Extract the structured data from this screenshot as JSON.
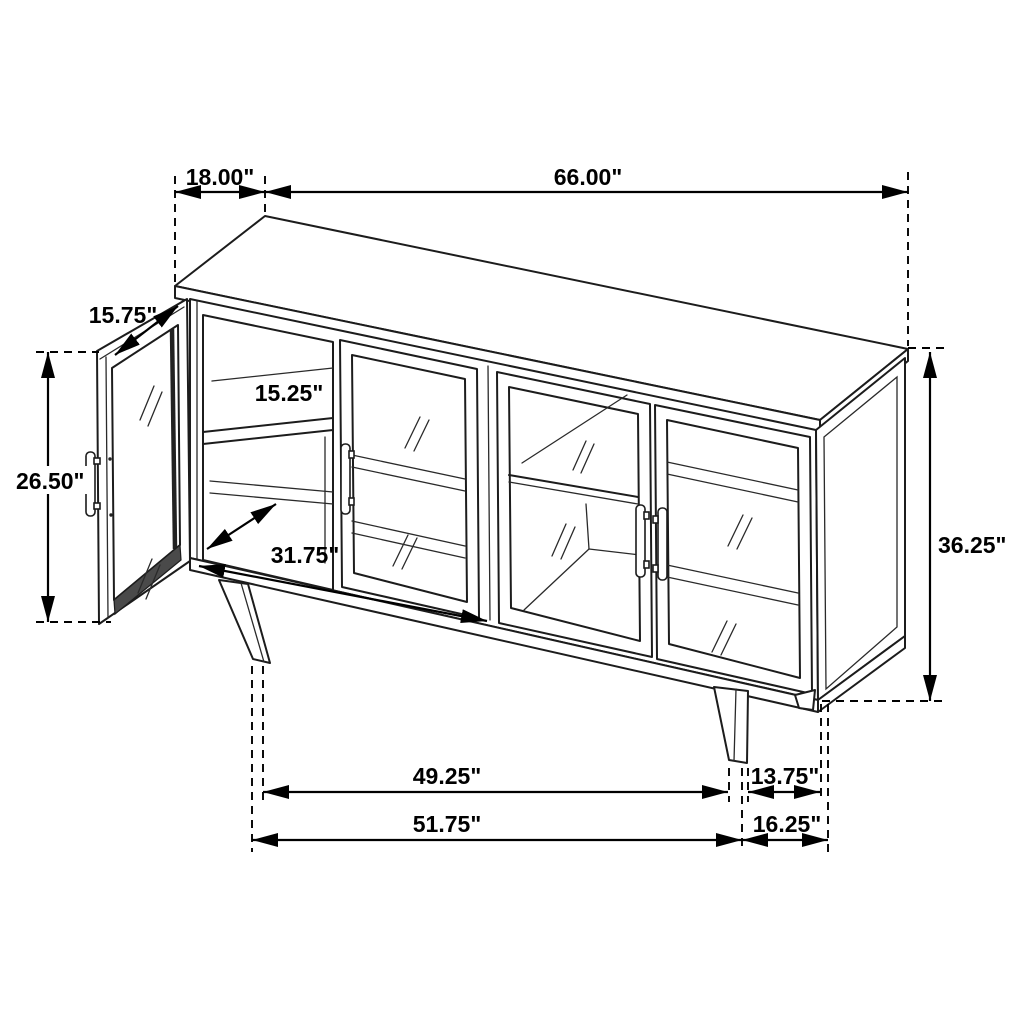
{
  "drawing": {
    "type": "furniture-dimension-diagram",
    "subject": "Sideboard accent cabinet with four glass doors, left door open, tapered legs",
    "units": "inches",
    "line_color": "#000000",
    "background": "#ffffff"
  },
  "dims": {
    "top_depth": {
      "label": "18.00\"",
      "inches": 18.0,
      "measures": "top surface depth"
    },
    "top_width": {
      "label": "66.00\"",
      "inches": 66.0,
      "measures": "overall width"
    },
    "door_width": {
      "label": "15.75\"",
      "inches": 15.75,
      "measures": "door leaf width"
    },
    "door_height": {
      "label": "26.50\"",
      "inches": 26.5,
      "measures": "door opening height"
    },
    "shelf_depth": {
      "label": "15.25\"",
      "inches": 15.25,
      "measures": "interior shelf depth"
    },
    "interior_width": {
      "label": "31.75\"",
      "inches": 31.75,
      "measures": "interior compartment width"
    },
    "overall_height": {
      "label": "36.25\"",
      "inches": 36.25,
      "measures": "overall height"
    },
    "leg_span_inner": {
      "label": "49.25\"",
      "inches": 49.25,
      "measures": "front leg inner span"
    },
    "side_depth_inner": {
      "label": "13.75\"",
      "inches": 13.75,
      "measures": "side leg inner depth"
    },
    "leg_span_outer": {
      "label": "51.75\"",
      "inches": 51.75,
      "measures": "front leg outer span"
    },
    "side_depth_outer": {
      "label": "16.25\"",
      "inches": 16.25,
      "measures": "side leg outer depth"
    }
  }
}
